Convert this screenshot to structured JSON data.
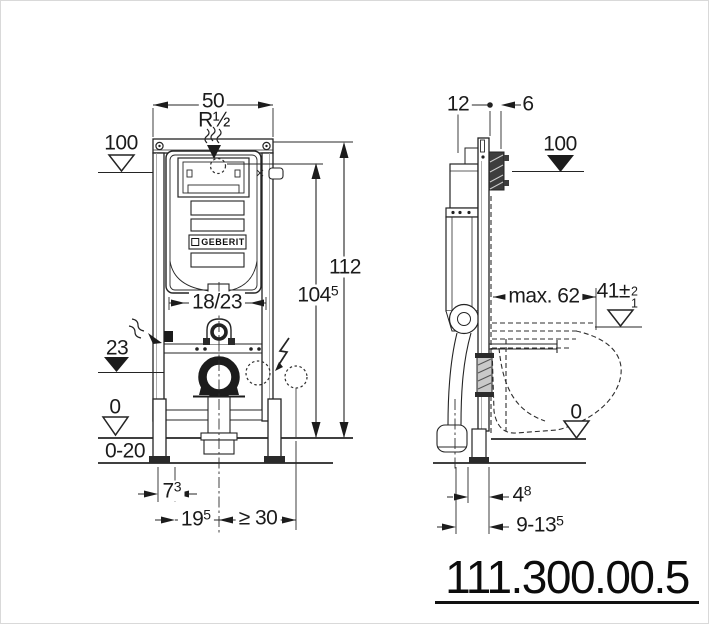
{
  "front_view": {
    "width_top": "50",
    "water_connection": "R½",
    "meter_mark": "100",
    "total_height": "112",
    "supply_height": {
      "base": "104",
      "sup": "5"
    },
    "flush_pipe_offset": "18/23",
    "outlet_height": "23",
    "floor_level": "0",
    "screed_range": "0-20",
    "foot_offset": {
      "base": "7",
      "sup": "3"
    },
    "outlet_to_foot": {
      "base": "19",
      "sup": "5"
    },
    "min_side_clearance": "≥ 30"
  },
  "side_view": {
    "frame_depth": "12",
    "bracket_depth": "6",
    "meter_mark": "100",
    "max_bowl_depth": "max. 62",
    "seat_height": {
      "base": "41±",
      "tol_plus": "2",
      "tol_minus": "1"
    },
    "floor_level": "0",
    "foot_depth": {
      "base": "4",
      "sup": "8"
    },
    "wall_distance": {
      "base": "9-13",
      "sup": "5"
    }
  },
  "cistern_brand": "GEBERIT",
  "article_number": "111.300.00.5",
  "colors": {
    "line": "#242424",
    "fill": "#ffffff",
    "dark": "#1c1c1c"
  }
}
